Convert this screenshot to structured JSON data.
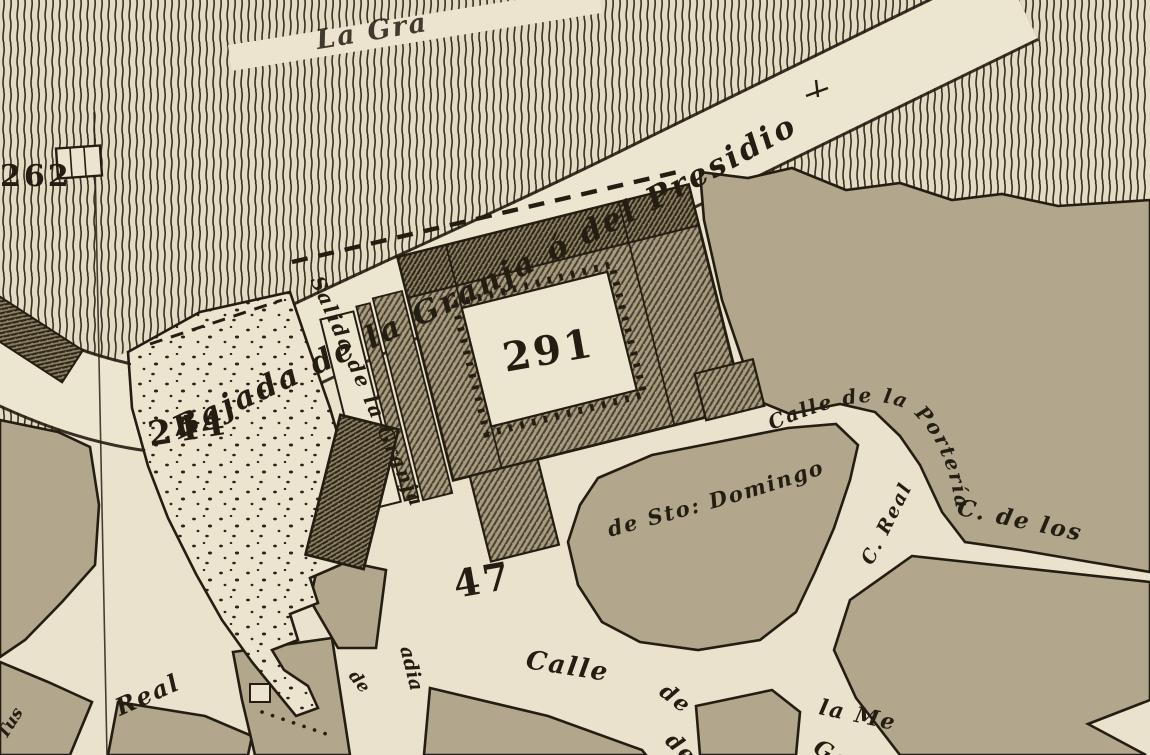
{
  "map": {
    "title": "historic-town-plan",
    "labels": {
      "top_path": "La Gra",
      "bajada": "Bajada de la Granja ó del Presidio",
      "salida": "Salida de la Granja",
      "porteria": "Calle de la Portería",
      "sto_domingo": "de Sto: Domingo",
      "c_real": "C. Real",
      "c_de_los": "C. de los",
      "calle": "Calle",
      "de_upper": "de",
      "de_lower": "de",
      "la_me": "la Me",
      "ga": "Ga",
      "real": "Real",
      "de_west": "de",
      "abadia_frag": "adia",
      "left_frag": "Tus"
    },
    "numbers": {
      "hill_262": "262",
      "garden_244": "244",
      "complex_291": "291",
      "plaza_47": "47"
    },
    "colors": {
      "paper": "#eae2cc",
      "street": "#ede6d1",
      "tan_block": "#b2a78c",
      "tan_block_dark": "#aba078",
      "ink": "#241d12",
      "hatch_base": "#a79c7f",
      "hatch_dark_base": "#8e8266",
      "hachure_ink": "#37301f"
    }
  }
}
